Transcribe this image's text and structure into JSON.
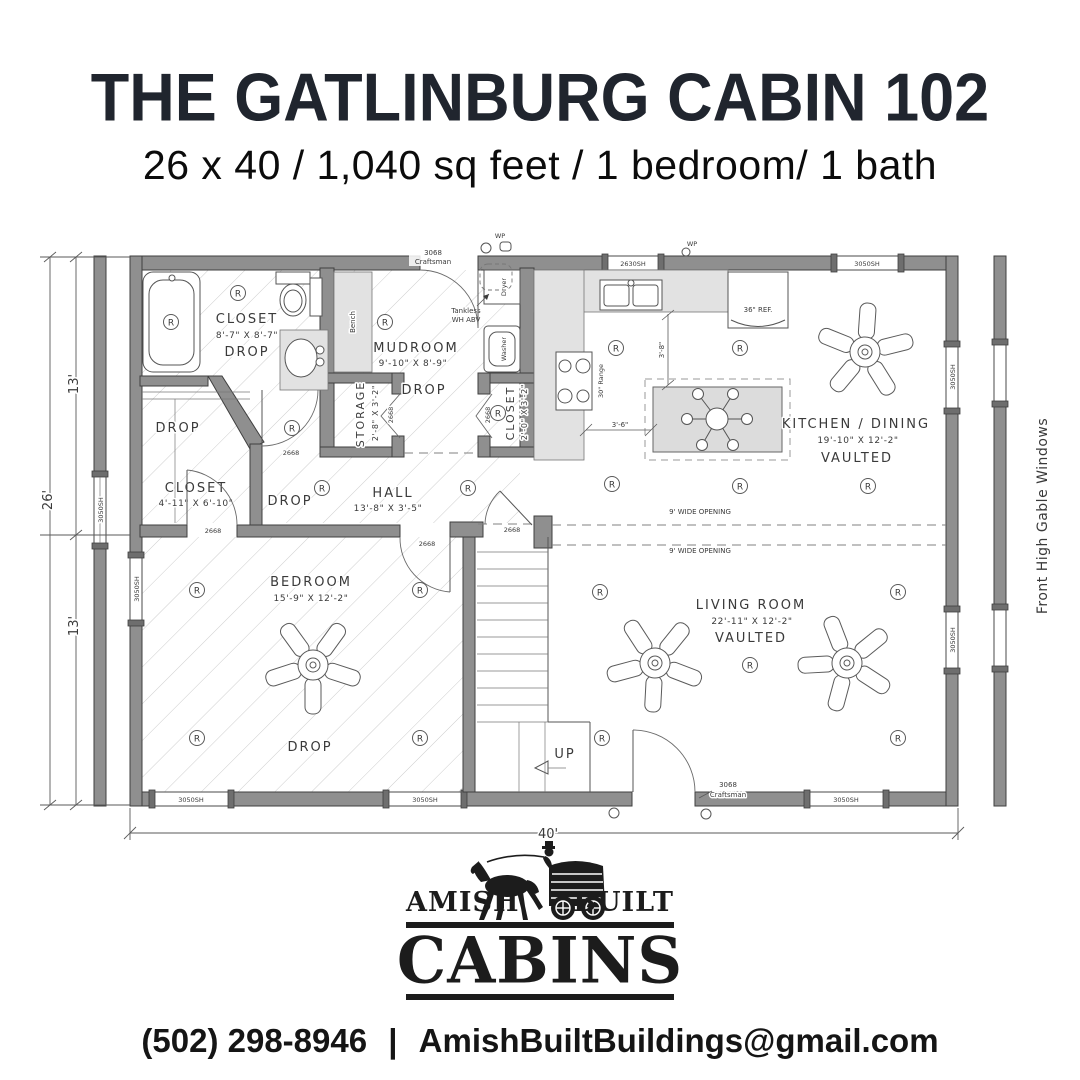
{
  "header": {
    "title": "THE GATLINBURG CABIN 102",
    "subtitle": "26 x 40 / 1,040 sq feet / 1 bedroom/ 1 bath"
  },
  "plan": {
    "rooms": {
      "bathroom": {
        "name": "CLOSET",
        "dims": "8'-7\" X 8'-7\"",
        "ceiling": "DROP"
      },
      "mudroom": {
        "name": "MUDROOM",
        "dims": "9'-10\" X 8'-9\"",
        "ceiling": "DROP"
      },
      "storage": {
        "name": "STORAGE",
        "dims": "2'-8\" X 3'-2\""
      },
      "closet_small": {
        "name": "CLOSET",
        "dims": "2'-0\" X 3'-2\""
      },
      "closet_left": {
        "name": "CLOSET",
        "dims": "4'-11\" X 6'-10\""
      },
      "hall": {
        "name": "HALL",
        "dims": "13'-8\" X 3'-5\""
      },
      "bedroom": {
        "name": "BEDROOM",
        "dims": "15'-9\" X 12'-2\"",
        "ceiling": "DROP"
      },
      "kitchen": {
        "name": "KITCHEN / DINING",
        "dims": "19'-10\" X 12'-2\"",
        "ceiling": "VAULTED"
      },
      "living": {
        "name": "LIVING ROOM",
        "dims": "22'-11\" X 12'-2\"",
        "ceiling": "VAULTED"
      }
    },
    "labels": {
      "drop": "DROP",
      "up": "UP",
      "bench": "Bench",
      "washer": "Washer",
      "dryer": "Dryer",
      "tankless_1": "Tankless",
      "tankless_2": "WH ABV",
      "range": "30\" Range",
      "fridge": "36\" REF.",
      "wide_opening": "9' WIDE OPENING",
      "island_depth": "3'-8\"",
      "island_gap": "3'-6\"",
      "wp": "WP",
      "gable_note": "Front High Gable Windows"
    },
    "openings": {
      "door_entry": "3068",
      "door_entry_style": "Craftsman",
      "door_interior": "2668",
      "window_large": "3050SH",
      "window_kitchen": "2630SH"
    },
    "dimensions": {
      "width_total": "40'",
      "depth_total": "26'",
      "depth_half_top": "13'",
      "depth_half_bottom": "13'"
    },
    "symbols": {
      "recessed_light": "R"
    },
    "colors": {
      "wall_gray": "#8f8f8f",
      "counter_gray": "#e2e2e2",
      "ink": "#3a3a3a"
    }
  },
  "logo": {
    "word_left": "AMISH",
    "word_right": "BUILT",
    "word_main": "CABINS"
  },
  "footer": {
    "phone": "(502) 298-8946",
    "separator": "|",
    "email": "AmishBuiltBuildings@gmail.com"
  }
}
